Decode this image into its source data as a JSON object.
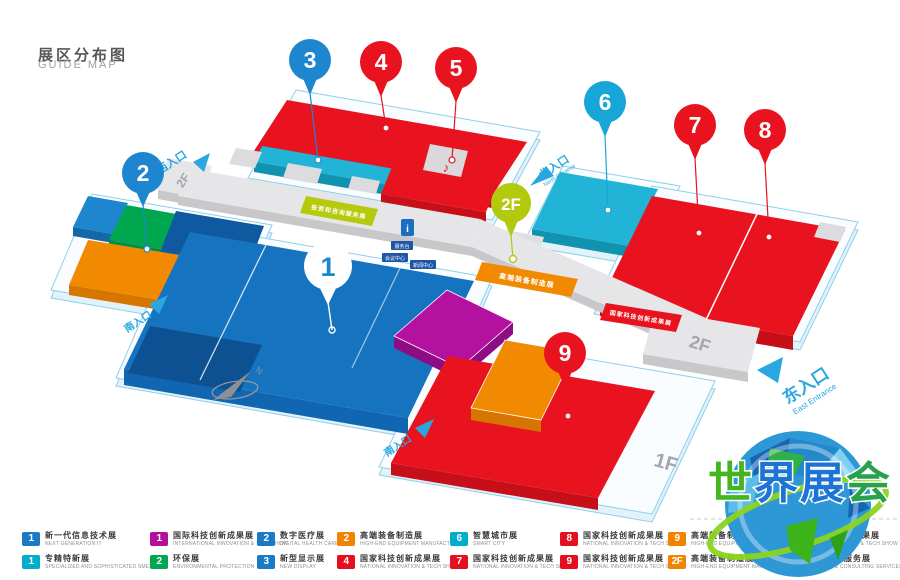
{
  "title": {
    "zh": "展区分布图",
    "en": "GUIDE MAP"
  },
  "colors": {
    "pin_blue": "#1e86cf",
    "pin_cyan": "#18a5d8",
    "pin_red": "#e8131f",
    "pin_lime": "#b2c90e",
    "pin_white": "#ffffff",
    "hall_blue": "#1673c0",
    "hall_blue_dark": "#0d5193",
    "hall_blue_front": "#1166b2",
    "cyan": "#22b4d6",
    "cyan_front": "#0f93af",
    "red": "#e8131f",
    "red_front": "#c60f19",
    "orange": "#f18a00",
    "orange_front": "#d67500",
    "magenta": "#b511a0",
    "magenta_front": "#8e0c84",
    "green": "#00a74f",
    "dark_blue": "#0e59a0",
    "lime": "#b5ca0c",
    "grey_top": "#e6e6e8",
    "grey_front": "#c8c8cb",
    "entrance_blue": "#2aa7e0"
  },
  "map": {
    "pins": {
      "p1": {
        "label": "1"
      },
      "p2": {
        "label": "2"
      },
      "p3": {
        "label": "3"
      },
      "p4": {
        "label": "4"
      },
      "p5": {
        "label": "5"
      },
      "p6": {
        "label": "6"
      },
      "p7": {
        "label": "7"
      },
      "p8": {
        "label": "8"
      },
      "p9": {
        "label": "9"
      },
      "p2f": {
        "label": "2F"
      }
    },
    "floors": {
      "west_2f": "2F",
      "east_2f": "2F",
      "bottom_1f": "1F"
    },
    "entrances": {
      "west": {
        "zh": "西入口"
      },
      "north": {
        "zh": "北入口",
        "en": "North Entrance"
      },
      "east": {
        "zh": "东入口",
        "en": "East Entrance"
      },
      "south_left": {
        "zh": "南入口"
      },
      "south_mid": {
        "zh": "南入口"
      }
    },
    "strips": {
      "lime_label": "投资和咨询服务展",
      "orange_label": "高端装备制造展",
      "red_label": "国家科技创新成果展"
    },
    "facilities": {
      "info_icon": "i",
      "desk": "服务台",
      "meeting": "会议中心",
      "news": "新闻中心",
      "stage_icon": "♪"
    },
    "compass_n": "N"
  },
  "legend": {
    "items": [
      {
        "num": "1",
        "color": "#1b7ac4",
        "zh": "新一代信息技术展",
        "en": "NEXT GENERATION IT"
      },
      {
        "num": "1",
        "color": "#00aecb",
        "zh": "专精特新展",
        "en": "SPECIALIZED AND SOPHISTICATED SMES"
      },
      {
        "num": "1",
        "color": "#b30f9b",
        "zh": "国际科技创新成果展",
        "en": "INTERNATIONAL INNOVATION & TECH SHOW"
      },
      {
        "num": "2",
        "color": "#00a651",
        "zh": "环保展",
        "en": "ENVIRONMENTAL PROTECTION"
      },
      {
        "num": "2",
        "color": "#1b7ac4",
        "zh": "数字医疗展",
        "en": "DIGITAL HEALTH CARE"
      },
      {
        "num": "3",
        "color": "#1b7ac4",
        "zh": "新型显示展",
        "en": "NEW DISPLAY"
      },
      {
        "num": "2",
        "color": "#f08300",
        "zh": "高端装备制造展",
        "en": "HIGH-END EQUIPMENT MANUFACTURING"
      },
      {
        "num": "4",
        "color": "#e60f1e",
        "zh": "国家科技创新成果展",
        "en": "NATIONAL INNOVATION & TECH SHOW"
      },
      {
        "num": "6",
        "color": "#00aecb",
        "zh": "智慧城市展",
        "en": "SMART CITY"
      },
      {
        "num": "7",
        "color": "#e60f1e",
        "zh": "国家科技创新成果展",
        "en": "NATIONAL INNOVATION & TECH SHOW"
      },
      {
        "num": "8",
        "color": "#e60f1e",
        "zh": "国家科技创新成果展",
        "en": "NATIONAL INNOVATION & TECH SHOW"
      },
      {
        "num": "9",
        "color": "#e60f1e",
        "zh": "国家科技创新成果展",
        "en": "NATIONAL INNOVATION & TECH SHOW"
      },
      {
        "num": "9",
        "color": "#f08300",
        "zh": "高端装备制造展",
        "en": "HIGH-END EQUIPMENT MANUFACTURING"
      },
      {
        "num": "2F",
        "color": "#f08300",
        "zh": "高端装备制造展",
        "en": "HIGH-END EQUIPMENT MANUFACTURING"
      },
      {
        "num": "5",
        "color": "#e60f1e",
        "zh": "国家科技创新成果展",
        "en": "NATIONAL INNOVATION & TECH SHOW"
      },
      {
        "num": "2F",
        "color": "#b5ca0c",
        "zh": "投资和咨询服务展",
        "en": "INVESTMENT & CONSULTING SERVICES"
      }
    ]
  },
  "logo": {
    "chars": [
      {
        "t": "世",
        "c": "#44b51c"
      },
      {
        "t": "界",
        "c": "#1d74d4"
      },
      {
        "t": "展",
        "c": "#1d74d4"
      },
      {
        "t": "会",
        "c": "#27a24b"
      }
    ]
  }
}
